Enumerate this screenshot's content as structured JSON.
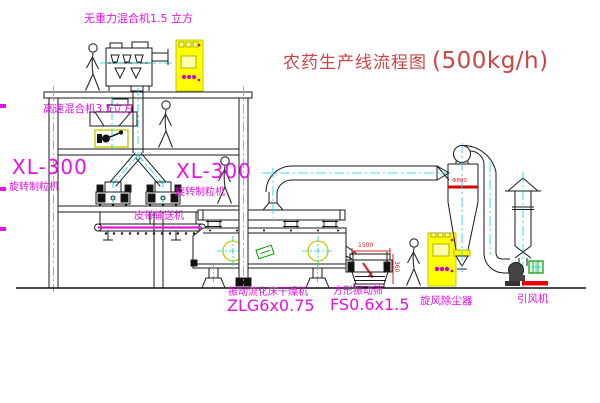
{
  "title": {
    "cn": "农药生产线流程图",
    "capacity": "(500kg/h)"
  },
  "labels": {
    "gravity_mixer": "无重力混合机1.5 立方",
    "high_speed_mixer": "高速混合机3.5立方",
    "granulator_left_model": "XL-300",
    "granulator_left_name": "旋转制粒机",
    "granulator_right_model": "XL-300",
    "granulator_right_name": "旋转制粒机",
    "belt_conveyor": "皮带输送机",
    "dryer_name": "振动流化床干燥机",
    "dryer_model": "ZLG6x0.75",
    "sieve_name": "方形振动筛",
    "sieve_model": "FS0.6x1.5",
    "cyclone": "旋风除尘器",
    "fan": "引风机"
  },
  "dimensions": {
    "sieve_length": "1500",
    "sieve_height": "360",
    "cyclone_diameter": "Φ800"
  },
  "colors": {
    "magenta": "#e511e5",
    "red": "#cc4444",
    "dimred": "#dd2222",
    "yellow": "#ffff00",
    "cyan": "#00d8d8",
    "green": "#00a000",
    "line": "#1a1a1a"
  }
}
